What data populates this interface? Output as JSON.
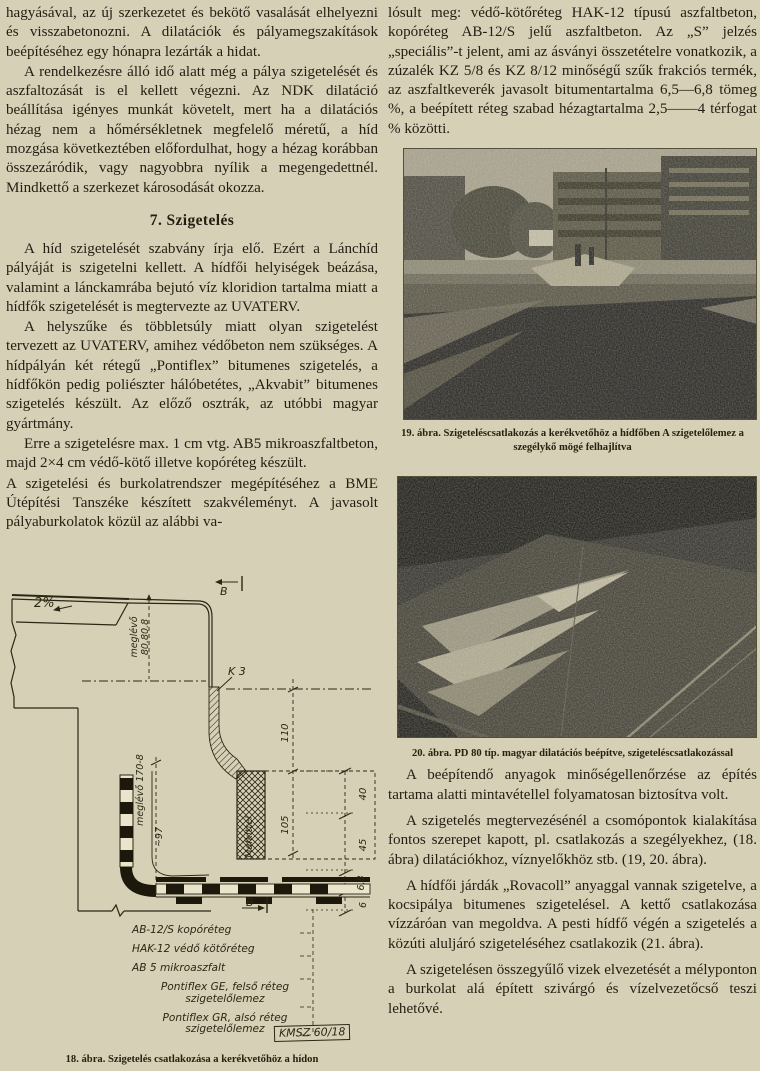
{
  "page": {
    "paper_color": "#d6d0b6",
    "ink_color": "#221e12"
  },
  "left_column": {
    "paragraphs": [
      "hagyásával, az új szerkezetet és bekötő vasalását elhelyezni és visszabetonozni. A dilatációk és pályamegszakítások beépítéséhez egy hónapra lezárták a hidat.",
      "A rendelkezésre álló idő alatt még a pálya szigetelését és aszfaltozását is el kellett végezni. Az NDK dilatáció beállítása igényes munkát követelt, mert ha a dilatációs hézag nem a hőmérsékletnek megfelelő méretű, a híd mozgása következtében előfordulhat, hogy a hézag korábban összezáródik, vagy nagyobbra nyílik a megengedettnél. Mindkettő a szerkezet károsodását okozza.",
      "A híd szigetelését szabvány írja elő. Ezért a Lánchíd pályáját is szigetelni kellett. A hídfői helyiségek beázása, valamint a lánckamrába bejutó víz kloridion tartalma miatt a hídfők szigetelését is megtervezte az UVATERV.",
      "A helyszűke és többletsúly miatt olyan szigetelést tervezett az UVATERV, amihez védőbeton nem szükséges. A hídpályán két rétegű „Pontiflex” bitumenes szigetelés, a hídfőkön pedig poliészter hálóbetétes, „Akvabit” bitumenes szigetelés készült. Az előző osztrák, az utóbbi magyar gyártmány.",
      "Erre a szigetelésre max. 1 cm vtg. AB5 mikroaszfaltbeton, majd 2×4 cm védő-kötő illetve kopóréteg készült.",
      "A szigetelési és burkolatrendszer megépítéséhez a BME Útépítési Tanszéke készített szakvéleményt. A javasolt pályaburkolatok közül az alábbi va-"
    ],
    "section_heading": "7. Szigetelés",
    "figure18": {
      "caption": "18. ábra. Szigetelés csatlakozása a kerékvetőhöz a hídon",
      "labels": {
        "slope": "2%",
        "section_marker_top": "B",
        "section_marker_bottom": "B",
        "k3": "K 3",
        "existing_angle_1": "meglévő",
        "existing_angle_2": "80.80.8",
        "existing_side": "meglévő 170-8",
        "dim_97": "~97",
        "dim_110": "110",
        "dim_105": "105",
        "dim_40": "40",
        "dim_45": "45",
        "dim_6_8": "6,8",
        "dim_6": "6",
        "mafkittel": "Mafkittel"
      },
      "legend": [
        "AB-12/S kopóréteg",
        "HAK-12 védő kötőréteg",
        "AB 5 mikroaszfalt",
        "Pontiflex GE, felső réteg szigetelőlemez",
        "Pontiflex GR, alsó réteg szigetelőlemez"
      ],
      "stamp": "KMSZ 60/18"
    }
  },
  "right_column": {
    "paragraphs": [
      "lósult meg: védő-kötőréteg HAK-12 típusú aszfaltbeton, kopóréteg AB-12/S jelű aszfaltbeton. Az „S” jelzés „speciális”-t jelent, ami az ásványi összetételre vonatkozik, a zúzalék KZ 5/8 és KZ 8/12 minőségű szűk frakciós termék, az aszfaltkeverék javasolt bitumentartalma 6,5—6,8 tömeg %, a beépített réteg szabad hézagtartalma 2,5——4 térfogat % közötti.",
      "A beépítendő anyagok minőségellenőrzése az építés tartama alatti mintavétellel folyamatosan biztosítva volt.",
      "A szigetelés megtervezésénél a csomópontok kialakítása fontos szerepet kapott, pl. csatlakozás a szegélyekhez, (18. ábra) dilatációkhoz, víznyelőkhöz stb. (19, 20. ábra).",
      "A hídfői járdák „Rovacoll” anyaggal vannak szigetelve, a kocsipálya bitumenes szigetelésel. A kettő csatlakozása vízzáróan van megoldva. A pesti hídfő végén a szigetelés a közúti aluljáró szigeteléséhez csatlakozik (21. ábra).",
      "A szigetelésen összegyűlő vizek elvezetését a mélyponton a burkolat alá épített szivárgó és vízelvezetőcső teszi lehetővé."
    ],
    "figure19": {
      "caption": "19. ábra. Szigeteléscsatlakozás a kerékvetőhöz a hídfőben A szigetelőlemez a szegélykő mögé felhajlítva",
      "photo_subject": "halftone photo: bridgehead roadway works, buildings and trees behind"
    },
    "figure20": {
      "caption": "20. ábra. PD 80 típ. magyar dilatációs beépítve, szigeteléscsatlakozással",
      "photo_subject": "halftone photo: dark asphalt bridge deck with expansion joint and light streaks"
    }
  }
}
